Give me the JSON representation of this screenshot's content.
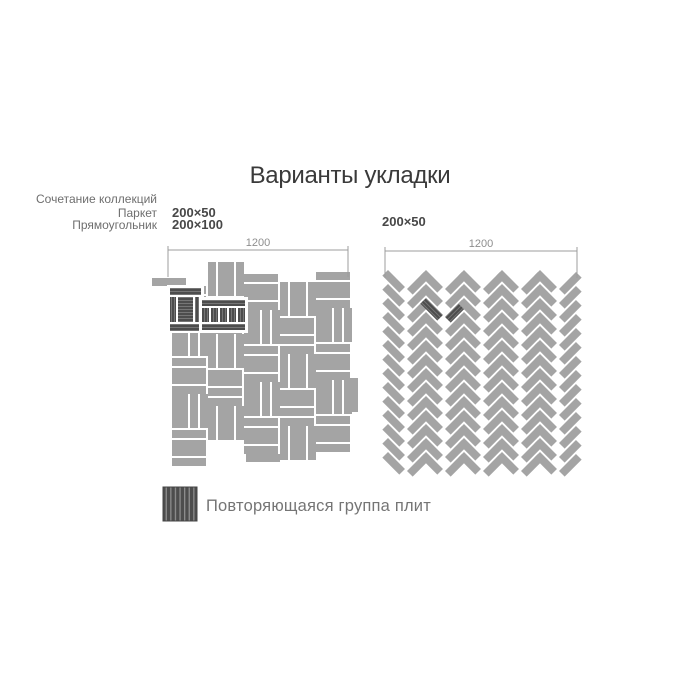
{
  "title": "Варианты укладки",
  "left_block": {
    "collections_note": "Сочетание коллекций",
    "collection_1": "Паркет",
    "collection_2": "Прямоугольник",
    "tile_size_1": "200×50",
    "tile_size_2": "200×100",
    "dimension": "1200"
  },
  "right_block": {
    "tile_size": "200×50",
    "dimension": "1200"
  },
  "legend": {
    "label": "Повторяющаяся группа плит"
  },
  "colors": {
    "background": "#ffffff",
    "tile_gray": "#a4a4a4",
    "joint_white": "#ffffff",
    "highlight_dark": "#4d4d4d",
    "highlight_streak": "#7a7a7a",
    "legend_streak": "#8d8d8d",
    "dimension_line": "#9c9c9c",
    "dimension_text": "#8e8e8e",
    "title_text": "#3a3a3a",
    "note_text": "#6e6e6e",
    "size_text": "#474747",
    "legend_text": "#757575"
  },
  "patterns": {
    "basketweave": {
      "x": 172,
      "y": 270,
      "module": 36,
      "cols": 5,
      "rows": 5,
      "col_offsets": [
        16,
        -8,
        4,
        12,
        2
      ],
      "extra_tiles": [
        [
          152,
          278,
          34,
          8
        ],
        [
          350,
          378,
          8,
          34
        ],
        [
          246,
          454,
          34,
          8
        ]
      ]
    },
    "herringbone": {
      "x": 388,
      "y": 270,
      "cols": 5,
      "rows": 14,
      "period": 38,
      "half": 19,
      "tile_len": 24,
      "tile_w": 8,
      "row_step": 14,
      "dark_col": 1,
      "dark_row": 2
    },
    "dims": {
      "left": {
        "x1": 168,
        "x2": 348,
        "y": 250
      },
      "right": {
        "x1": 385,
        "x2": 577,
        "y": 251
      },
      "drop": 27,
      "rise": 4
    },
    "legend_swatch": {
      "x": 163,
      "y": 487,
      "w": 34,
      "h": 34
    }
  }
}
